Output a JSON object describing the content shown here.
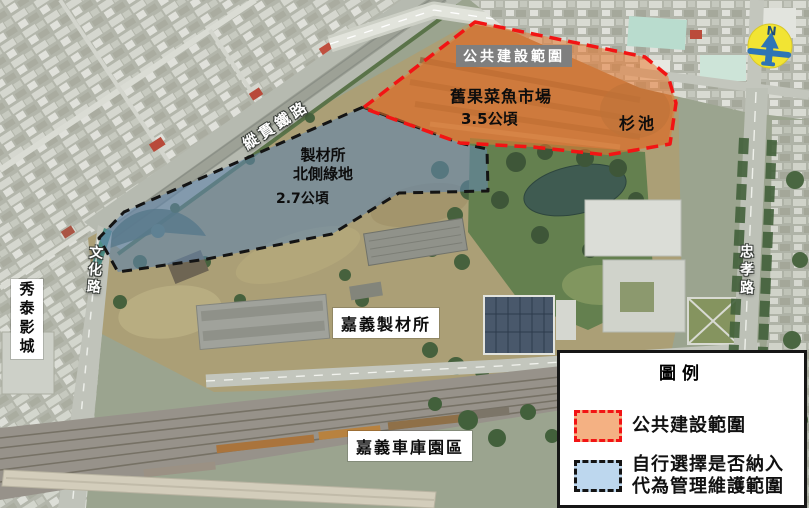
{
  "colors": {
    "public_fill": "#F4B183",
    "public_overlay": "rgba(231,121,47,0.55)",
    "public_border": "#F21414",
    "manage_fill": "#BDD7EE",
    "manage_overlay": "rgba(96,133,171,0.60)",
    "manage_border": "#141414",
    "label_box_gray": "#7F7F7F",
    "compass_yellow": "#F2E433",
    "compass_blue": "#2E74B5"
  },
  "annotations": {
    "public_zone_title": "公共建設範圍",
    "market_name": "舊果菜魚市場",
    "market_area": "3.5公頃",
    "pond_name": "杉池",
    "green_zone_line1": "製材所",
    "green_zone_line2": "北側綠地",
    "green_zone_area": "2.7公頃"
  },
  "roads": {
    "railway": "縱貫鐵路",
    "wenhua_road": "文化路",
    "zhongxiao_road": "忠孝路"
  },
  "places": {
    "cinema": "秀泰影城",
    "sawmill": "嘉義製材所",
    "depot_park": "嘉義車庫園區"
  },
  "compass": {
    "north_label": "N"
  },
  "legend": {
    "title": "圖例",
    "items": [
      {
        "label": "公共建設範圍"
      },
      {
        "label_line1": "自行選擇是否納入",
        "label_line2": "代為管理維護範圍"
      }
    ]
  }
}
